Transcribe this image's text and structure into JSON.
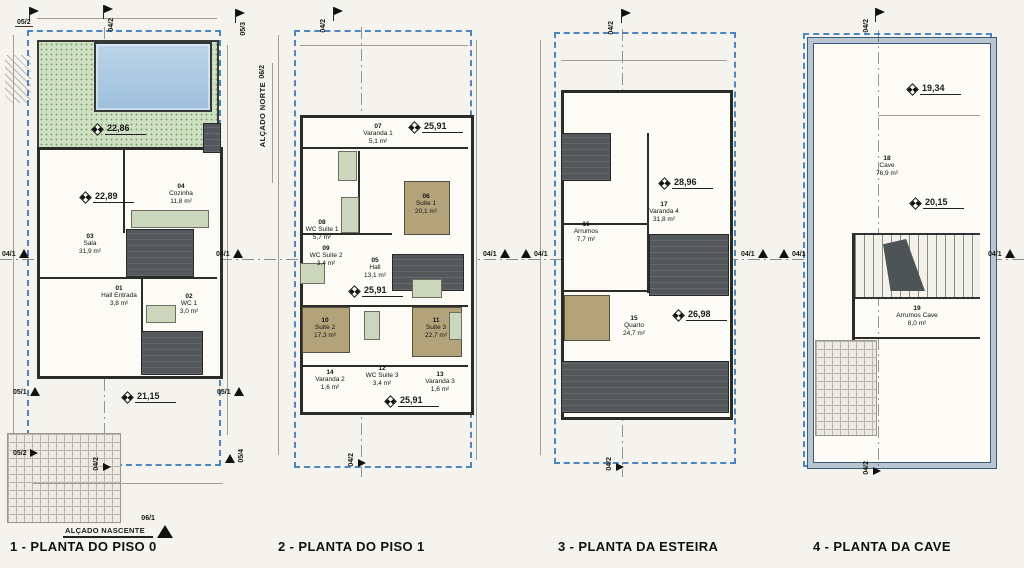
{
  "colors": {
    "paper": "#f4f3ed",
    "boundary_blue": "#4e86bd",
    "garden_green": "#cfe0c2",
    "pool_blue": "#a9c8e2",
    "stair_gray": "#54585b",
    "suite_brown": "#b3a37a",
    "wet_room_green": "#ccd6bd",
    "wall_dark": "#2b2b28"
  },
  "refs": {
    "r041": "04/1",
    "r042": "04/2",
    "r051": "05/1",
    "r052": "05/2",
    "r053": "05/3",
    "r054": "05/4",
    "r061": "06/1",
    "r062": "06/2"
  },
  "plans": [
    {
      "title": "1 - PLANTA DO PISO 0",
      "footer_label": "ALÇADO NASCENTE",
      "footer_ref": "06/1",
      "levels": [
        {
          "v": "22,86"
        },
        {
          "v": "22,89"
        },
        {
          "v": "21,15"
        }
      ],
      "rooms": [
        {
          "id": "03",
          "name": "Sala",
          "area": "31,9 m²"
        },
        {
          "id": "04",
          "name": "Cozinha",
          "area": "11,8 m²"
        },
        {
          "id": "01",
          "name": "Hall Entrada",
          "area": "3,8 m²"
        },
        {
          "id": "02",
          "name": "WC 1",
          "area": "3,0 m²"
        }
      ]
    },
    {
      "title": "2 - PLANTA DO PISO 1",
      "side_label": "ALÇADO NORTE",
      "side_ref": "06/2",
      "levels": [
        {
          "v": "25,91"
        },
        {
          "v": "25,91"
        },
        {
          "v": "25,91"
        }
      ],
      "rooms": [
        {
          "id": "07",
          "name": "Varanda 1",
          "area": "5,1 m²"
        },
        {
          "id": "08",
          "name": "WC Suite 1",
          "area": "5,7 m²"
        },
        {
          "id": "06",
          "name": "Suite 1",
          "area": "20,1 m²"
        },
        {
          "id": "09",
          "name": "WC Suite 2",
          "area": "3,4 m²"
        },
        {
          "id": "05",
          "name": "Hall",
          "area": "13,1 m²"
        },
        {
          "id": "10",
          "name": "Suite 2",
          "area": "17,3 m²"
        },
        {
          "id": "11",
          "name": "Suite 3",
          "area": "22,7 m²"
        },
        {
          "id": "14",
          "name": "Varanda 2",
          "area": "1,6 m²"
        },
        {
          "id": "12",
          "name": "WC Suite 3",
          "area": "3,4 m²"
        },
        {
          "id": "13",
          "name": "Varanda 3",
          "area": "1,6 m²"
        }
      ]
    },
    {
      "title": "3 - PLANTA DA ESTEIRA",
      "levels": [
        {
          "v": "28,96"
        },
        {
          "v": "26,98"
        }
      ],
      "rooms": [
        {
          "id": "17",
          "name": "Varanda 4",
          "area": "31,8 m²"
        },
        {
          "id": "16",
          "name": "Arrumos",
          "area": "7,7 m²"
        },
        {
          "id": "15",
          "name": "Quarto",
          "area": "24,7 m²"
        }
      ]
    },
    {
      "title": "4 - PLANTA DA CAVE",
      "levels": [
        {
          "v": "19,34"
        },
        {
          "v": "20,15"
        }
      ],
      "rooms": [
        {
          "id": "18",
          "name": "Cave",
          "area": "76,9 m²"
        },
        {
          "id": "19",
          "name": "Arrumos Cave",
          "area": "8,0 m²"
        }
      ]
    }
  ]
}
